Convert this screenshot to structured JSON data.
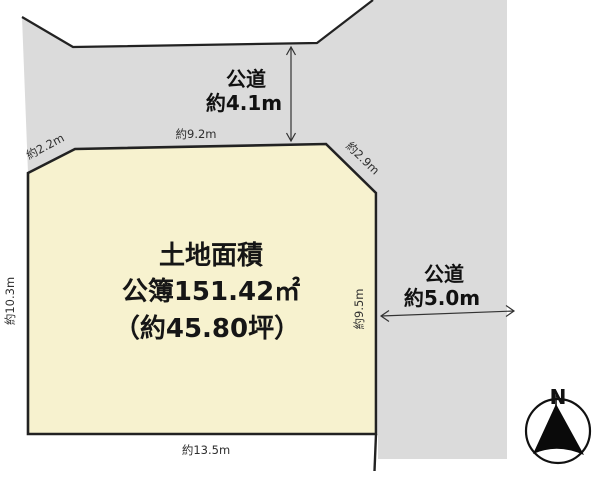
{
  "diagram": {
    "parcel": {
      "area_title": "土地面積",
      "area_registered": "公簿151.42㎡",
      "area_tsubo": "（約45.80坪）"
    },
    "roads": {
      "top": {
        "name": "公道",
        "width": "約4.1m"
      },
      "right": {
        "name": "公道",
        "width": "約5.0m"
      }
    },
    "dimensions": {
      "top_left_diagonal": "約2.2m",
      "top_edge": "約9.2m",
      "top_right_diagonal": "約2.9m",
      "left_edge": "約10.3m",
      "right_edge": "約9.5m",
      "bottom_edge": "約13.5m"
    },
    "compass": {
      "north_label": "N"
    },
    "colors": {
      "parcel_fill": "#f7f2cf",
      "road_fill": "#dbdbdb",
      "line": "#222222"
    }
  }
}
